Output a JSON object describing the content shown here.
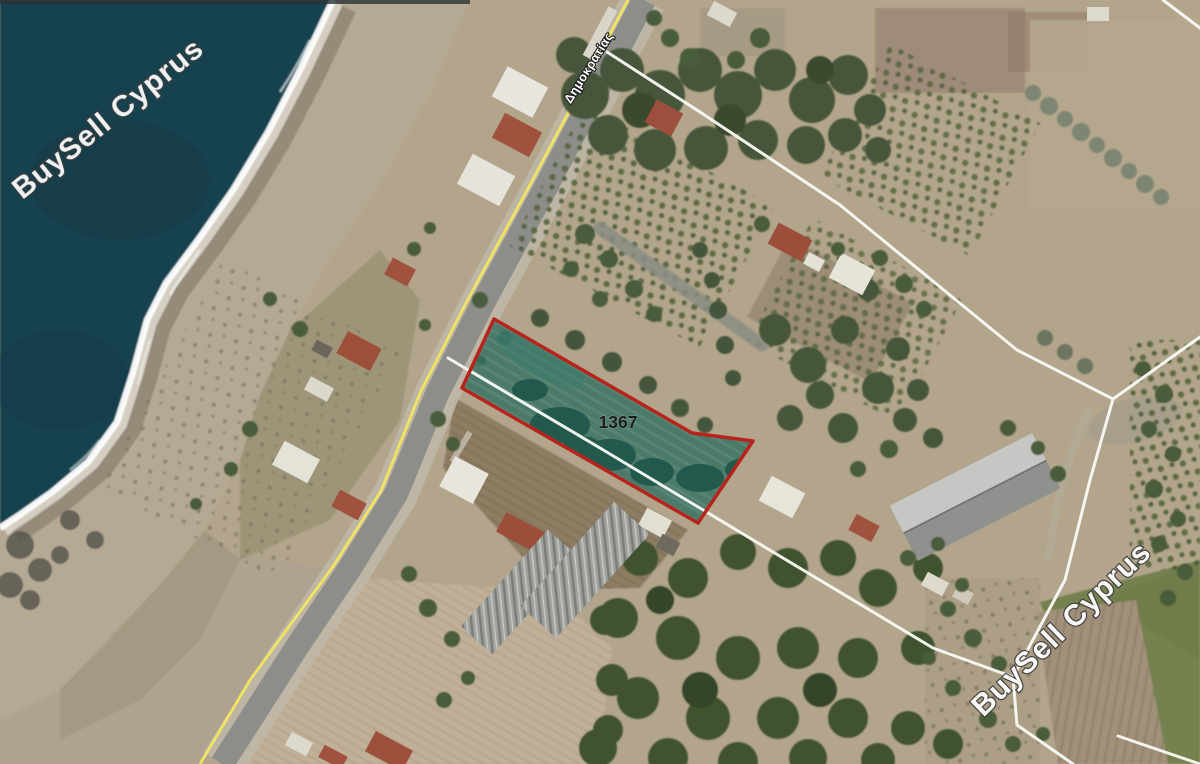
{
  "map": {
    "type": "satellite-cadastral",
    "watermark_text": "BuySell Cyprus",
    "parcel": {
      "id_label": "1367"
    },
    "road_label": "Δημοκρατίας",
    "colors": {
      "sea": "#16424f",
      "parcel_fill": "#2e6e60",
      "parcel_border": "#b8241b",
      "route_line": "#f2e75f",
      "cadastral_line": "#f8f8f3",
      "parcel_label_color": "#1c1c1c",
      "watermark_fill": "#ffffff",
      "watermark_outline": "#3c3c3c"
    }
  }
}
